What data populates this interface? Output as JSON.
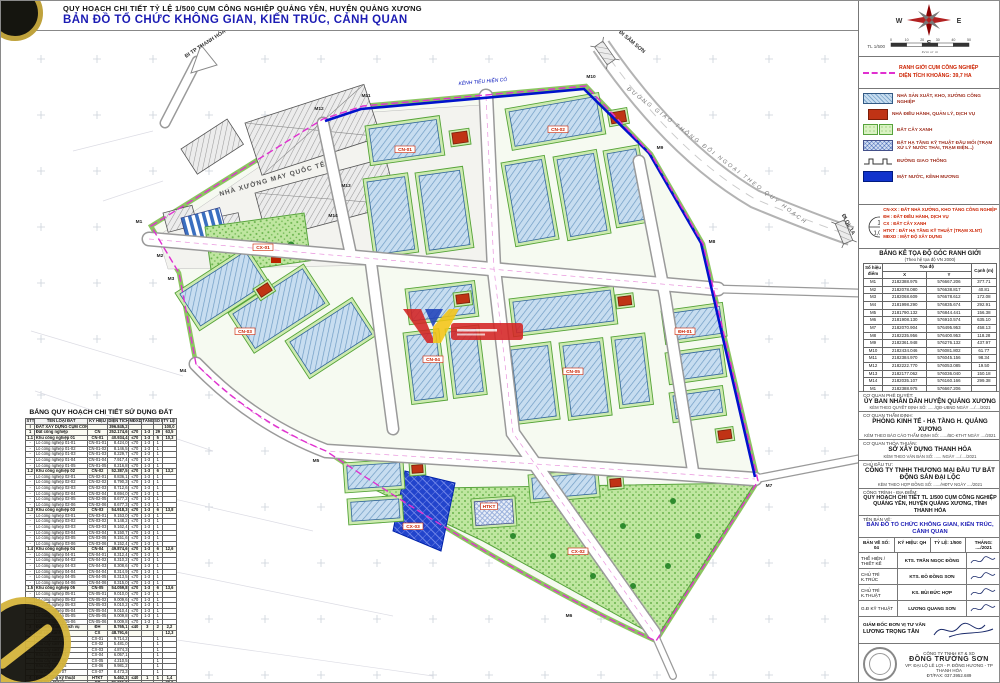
{
  "colors": {
    "accent_blue": "#1c1cb4",
    "boundary_magenta": "#e030d0",
    "red": "#cc2200",
    "canal_blue": "#0012cc",
    "lot_green": "#55a337",
    "building_blue": "#c7ddf0"
  },
  "header": {
    "line1": "QUY HOẠCH CHI TIẾT TỶ LỆ 1/500 CỤM CÔNG NGHIỆP QUẢNG YÊN, HUYỆN QUẢNG XƯƠNG",
    "line2": "BẢN ĐỒ TỔ CHỨC KHÔNG GIAN, KIẾN TRÚC, CẢNH QUAN"
  },
  "compass": {
    "w": "W",
    "e": "E",
    "s": "S",
    "scale_label": "TL 1/500",
    "scale_unit": "Đơn vị: m",
    "ticks": [
      "0",
      "10",
      "20",
      "30",
      "40",
      "50"
    ]
  },
  "boundary_legend": {
    "line1": "RANH GIỚI CỤM CÔNG NGHIỆP",
    "line2": "DIỆN TÍCH KHOẢNG: 39,7 HA"
  },
  "legend": {
    "items": [
      {
        "cls": "sw-cn",
        "text": "NHÀ SẢN XUẤT, KHO, XƯỞNG CÔNG NGHIỆP"
      },
      {
        "cls": "sw-dh",
        "text": "NHÀ ĐIỀU HÀNH, QUẢN LÝ, DỊCH VỤ"
      },
      {
        "cls": "sw-cx",
        "text": "ĐẤT CÂY XANH"
      },
      {
        "cls": "sw-htkt",
        "text": "ĐẤT HẠ TẦNG KỸ THUẬT ĐẦU MỐI (TRẠM XỬ LÝ NƯỚC THẢI, TRẠM ĐIỆN...)"
      },
      {
        "cls": "sw-road",
        "text": "ĐƯỜNG GIAO THÔNG"
      },
      {
        "cls": "sw-mn",
        "text": "MẶT NƯỚC, KÊNH MƯƠNG"
      }
    ]
  },
  "symbols": {
    "circle_top": "1",
    "circle_bottom": "1,05",
    "callout_top": "SỐ Ô ĐẤT",
    "callout_bottom": "DT (HA)",
    "lines": [
      "CN-XX : ĐẤT NHÀ XƯỞNG, KHO TÀNG CÔNG NGHIỆP",
      "ĐH : ĐẤT ĐIỀU HÀNH, DỊCH VỤ",
      "CX : ĐẤT CÂY XANH",
      "HTKT : ĐẤT HẠ TẦNG KỸ THUẬT (TRẠM XLNT)",
      "MĐXD : MẬT ĐỘ XÂY DỰNG"
    ]
  },
  "coord_table": {
    "title": "BẢNG KÊ TỌA ĐỘ GÓC RANH GIỚI",
    "subtitle": "(Theo hệ tọa độ VN 2000)",
    "c_point": "Số hiệu điểm",
    "c_coord": "Tọa độ",
    "c_x": "X",
    "c_y": "Y",
    "c_edge": "Cạnh (m)",
    "rows": [
      [
        "M1",
        "2182388.975",
        "576667.206",
        "377.71"
      ],
      [
        "M2",
        "2182078.080",
        "576638.817",
        "40.81"
      ],
      [
        "M3",
        "2182068.609",
        "576678.612",
        "172.08"
      ],
      [
        "M4",
        "2181998.290",
        "576835.674",
        "292.91"
      ],
      [
        "M5",
        "2181790.132",
        "576844.441",
        "156.38"
      ],
      [
        "M6",
        "2181908.130",
        "576910.574",
        "635.10"
      ],
      [
        "M7",
        "2182070.904",
        "576495.953",
        "458.13"
      ],
      [
        "M8",
        "2182235.956",
        "576400.953",
        "118.28"
      ],
      [
        "M9",
        "2182361.948",
        "576276.132",
        "437.97"
      ],
      [
        "M10",
        "2182434.046",
        "576081.802",
        "61.77"
      ],
      [
        "M11",
        "2182384.970",
        "576045.156",
        "98.34"
      ],
      [
        "M12",
        "2182222.770",
        "576053.085",
        "19.50"
      ],
      [
        "M13",
        "2182177.062",
        "576036.040",
        "150.18"
      ],
      [
        "M14",
        "2182035.107",
        "576160.166",
        "299.38"
      ],
      [
        "M1",
        "2182388.975",
        "576667.206",
        ""
      ]
    ]
  },
  "landuse": {
    "title": "BẢNG QUY HOẠCH CHI TIẾT SỬ DỤNG ĐẤT",
    "cols": [
      "STT",
      "TÊN LOẠI ĐẤT",
      "KÝ HIỆU",
      "DIỆN TÍCH (m²)",
      "MĐXD (%)",
      "TẦNG CAO",
      "SỐ LÔ",
      "TỶ LỆ (%)"
    ],
    "rows": [
      [
        "I",
        "ĐẤT XÂY DỰNG CỤM CÔNG NGHIỆP",
        "",
        "396.845,2",
        "",
        "",
        "",
        "100,0",
        "b"
      ],
      [
        "1",
        "Đất công nghiệp",
        "CN",
        "252.174,6",
        "≤70",
        "1-3",
        "29",
        "63,5",
        "b"
      ],
      [
        "1.1",
        "Khu công nghiệp 01",
        "CN-01",
        "40.934,4",
        "≤70",
        "1-3",
        "5",
        "10,3",
        "b"
      ],
      [
        "-",
        "Lô công nghiệp 01-01",
        "CN-01-01",
        "8.424,0",
        "≤70",
        "1-3",
        "1",
        "",
        ""
      ],
      [
        "-",
        "Lô công nghiệp 01-02",
        "CN-01-02",
        "8.146,5",
        "≤70",
        "1-3",
        "1",
        "",
        ""
      ],
      [
        "-",
        "Lô công nghiệp 01-03",
        "CN-01-03",
        "8.229,7",
        "≤70",
        "1-3",
        "1",
        "",
        ""
      ],
      [
        "-",
        "Lô công nghiệp 01-04",
        "CN-01-04",
        "7.917,4",
        "≤70",
        "1-3",
        "1",
        "",
        ""
      ],
      [
        "-",
        "Lô công nghiệp 01-05",
        "CN-01-05",
        "8.216,8",
        "≤70",
        "1-3",
        "1",
        "",
        ""
      ],
      [
        "1.2",
        "Khu công nghiệp 02",
        "CN-02",
        "52.387,5",
        "≤70",
        "1-3",
        "6",
        "13,2",
        "b"
      ],
      [
        "-",
        "Lô công nghiệp 02-01",
        "CN-02-01",
        "8.836,1",
        "≤70",
        "1-3",
        "1",
        "",
        ""
      ],
      [
        "-",
        "Lô công nghiệp 02-02",
        "CN-02-02",
        "8.790,3",
        "≤70",
        "1-3",
        "1",
        "",
        ""
      ],
      [
        "-",
        "Lô công nghiệp 02-03",
        "CN-02-03",
        "8.712,6",
        "≤70",
        "1-3",
        "1",
        "",
        ""
      ],
      [
        "-",
        "Lô công nghiệp 02-04",
        "CN-02-04",
        "8.694,0",
        "≤70",
        "1-3",
        "1",
        "",
        ""
      ],
      [
        "-",
        "Lô công nghiệp 02-05",
        "CN-02-05",
        "8.677,2",
        "≤70",
        "1-3",
        "1",
        "",
        ""
      ],
      [
        "-",
        "Lô công nghiệp 02-06",
        "CN-02-06",
        "8.677,3",
        "≤70",
        "1-3",
        "1",
        "",
        ""
      ],
      [
        "1.3",
        "Khu công nghiệp 03",
        "CN-03",
        "54.918,3",
        "≤70",
        "1-3",
        "6",
        "13,8",
        "b"
      ],
      [
        "-",
        "Lô công nghiệp 03-01",
        "CN-03-01",
        "9.153,0",
        "≤70",
        "1-3",
        "1",
        "",
        ""
      ],
      [
        "-",
        "Lô công nghiệp 03-02",
        "CN-03-02",
        "9.148,2",
        "≤70",
        "1-3",
        "1",
        "",
        ""
      ],
      [
        "-",
        "Lô công nghiệp 03-03",
        "CN-03-03",
        "9.162,4",
        "≤70",
        "1-3",
        "1",
        "",
        ""
      ],
      [
        "-",
        "Lô công nghiệp 03-04",
        "CN-03-04",
        "9.150,7",
        "≤70",
        "1-3",
        "1",
        "",
        ""
      ],
      [
        "-",
        "Lô công nghiệp 03-05",
        "CN-03-05",
        "9.151,6",
        "≤70",
        "1-3",
        "1",
        "",
        ""
      ],
      [
        "-",
        "Lô công nghiệp 03-06",
        "CN-03-06",
        "9.152,4",
        "≤70",
        "1-3",
        "1",
        "",
        ""
      ],
      [
        "1.4",
        "Khu công nghiệp 04",
        "CN-04",
        "49.874,6",
        "≤70",
        "1-3",
        "6",
        "12,6",
        "b"
      ],
      [
        "-",
        "Lô công nghiệp 04-01",
        "CN-04-01",
        "8.312,4",
        "≤70",
        "1-3",
        "1",
        "",
        ""
      ],
      [
        "-",
        "Lô công nghiệp 04-02",
        "CN-04-02",
        "8.310,2",
        "≤70",
        "1-3",
        "1",
        "",
        ""
      ],
      [
        "-",
        "Lô công nghiệp 04-03",
        "CN-04-03",
        "8.308,6",
        "≤70",
        "1-3",
        "1",
        "",
        ""
      ],
      [
        "-",
        "Lô công nghiệp 04-04",
        "CN-04-04",
        "8.314,9",
        "≤70",
        "1-3",
        "1",
        "",
        ""
      ],
      [
        "-",
        "Lô công nghiệp 04-05",
        "CN-04-05",
        "8.313,5",
        "≤70",
        "1-3",
        "1",
        "",
        ""
      ],
      [
        "-",
        "Lô công nghiệp 04-06",
        "CN-04-06",
        "8.315,0",
        "≤70",
        "1-3",
        "1",
        "",
        ""
      ],
      [
        "1.5",
        "Khu công nghiệp 05",
        "CN-05",
        "54.059,8",
        "≤70",
        "1-3",
        "6",
        "13,6",
        "b"
      ],
      [
        "-",
        "Lô công nghiệp 05-01",
        "CN-05-01",
        "9.010,0",
        "≤70",
        "1-3",
        "1",
        "",
        ""
      ],
      [
        "-",
        "Lô công nghiệp 05-02",
        "CN-05-02",
        "9.009,6",
        "≤70",
        "1-3",
        "1",
        "",
        ""
      ],
      [
        "-",
        "Lô công nghiệp 05-03",
        "CN-05-03",
        "9.010,2",
        "≤70",
        "1-3",
        "1",
        "",
        ""
      ],
      [
        "-",
        "Lô công nghiệp 05-04",
        "CN-05-04",
        "9.010,4",
        "≤70",
        "1-3",
        "1",
        "",
        ""
      ],
      [
        "-",
        "Lô công nghiệp 05-05",
        "CN-05-05",
        "9.009,8",
        "≤70",
        "1-3",
        "1",
        "",
        ""
      ],
      [
        "-",
        "Lô công nghiệp 05-06",
        "CN-05-06",
        "9.009,8",
        "≤70",
        "1-3",
        "1",
        "",
        ""
      ],
      [
        "2",
        "Đất điều hành, dịch vụ",
        "ĐH",
        "8.765,1",
        "≤40",
        "3",
        "2",
        "2,2",
        "b"
      ],
      [
        "3",
        "Đất cây xanh",
        "CX",
        "48.791,6",
        "",
        "",
        "",
        "12,3",
        "b"
      ],
      [
        "-",
        "Khu cây xanh 01",
        "CX-01",
        "9.714,2",
        "",
        "",
        "1",
        "",
        ""
      ],
      [
        "-",
        "Khu cây xanh 02",
        "CX-02",
        "5.481,0",
        "",
        "",
        "1",
        "",
        ""
      ],
      [
        "-",
        "Khu cây xanh 03",
        "CX-03",
        "4.874,3",
        "",
        "",
        "1",
        "",
        ""
      ],
      [
        "-",
        "Khu cây xanh 04",
        "CX-04",
        "6.057,1",
        "",
        "",
        "1",
        "",
        ""
      ],
      [
        "-",
        "Khu cây xanh 05",
        "CX-05",
        "4.210,5",
        "",
        "",
        "1",
        "",
        ""
      ],
      [
        "-",
        "Khu cây xanh 06",
        "CX-06",
        "9.981,2",
        "",
        "",
        "1",
        "",
        ""
      ],
      [
        "-",
        "Khu cây xanh 07",
        "CX-07",
        "8.473,3",
        "",
        "",
        "1",
        "",
        ""
      ],
      [
        "4",
        "Đất hạ tầng kỹ thuật",
        "HTKT",
        "5.462,3",
        "≤40",
        "1",
        "1",
        "1,4",
        "b"
      ],
      [
        "5",
        "Đất giao thông",
        "GT",
        "81.651,6",
        "",
        "",
        "",
        "20,6",
        "b"
      ],
      [
        "",
        "TỔNG CỘNG",
        "",
        "396.845,2",
        "",
        "",
        "",
        "100,0",
        "b"
      ]
    ]
  },
  "titleblock": {
    "approvals": [
      {
        "label": "CƠ QUAN PHÊ DUYỆT:",
        "name": "ỦY BAN NHÂN DÂN HUYỆN QUẢNG XƯƠNG",
        "note": "KÈM THEO QUYẾT ĐỊNH SỐ: ....../QĐ-UBND  NGÀY ..../..../2021"
      },
      {
        "label": "CƠ QUAN THẨM ĐỊNH:",
        "name": "PHÒNG KINH TẾ - HẠ TẦNG H. QUẢNG XƯƠNG",
        "note": "KÈM THEO BÁO CÁO THẨM ĐỊNH SỐ: ....../BC-KTHT  NGÀY ..../2021"
      },
      {
        "label": "CƠ QUAN THỎA THUẬN:",
        "name": "SỞ XÂY DỰNG THANH HÓA",
        "note": "KÈM THEO VĂN BẢN SỐ: ......  NGÀY ..../..../2021"
      },
      {
        "label": "CHỦ ĐẦU TƯ:",
        "name": "CÔNG TY TNHH THƯƠNG MẠI ĐẦU TƯ BẤT ĐỘNG SẢN ĐẠI LỘC",
        "note": "KÈM THEO HỢP ĐỒNG SỐ: ....../HĐTV  NGÀY ..../2021"
      }
    ],
    "project_label": "CÔNG TRÌNH - ĐỊA ĐIỂM:",
    "project_name": "QUY HOẠCH CHI TIẾT TL 1/500 CỤM CÔNG NGHIỆP QUẢNG YÊN, HUYỆN QUẢNG XƯƠNG, TỈNH THANH HÓA",
    "drawing_label": "TÊN BẢN VẼ:",
    "drawing_name": "BẢN ĐỒ TỔ CHỨC KHÔNG GIAN, KIẾN TRÚC, CẢNH QUAN",
    "meta": [
      "BẢN VẼ SỐ: 04",
      "KÝ HIỆU: QH",
      "TỶ LỆ: 1/500",
      "THÁNG: ..../2021"
    ],
    "signatures": [
      {
        "role": "THỂ HIỆN / THIẾT KẾ",
        "name": "KTS. TRẦN NGỌC ĐỒNG"
      },
      {
        "role": "CHỦ TRÌ K.TRÚC",
        "name": "KTS. ĐỖ ĐỒNG SƠN"
      },
      {
        "role": "CHỦ TRÌ K.THUẬT",
        "name": "KS. BÙI ĐỨC HỢP"
      },
      {
        "role": "G.Đ KỸ THUẬT",
        "name": "LƯƠNG QUANG SƠN"
      }
    ],
    "consultant_label": "GIÁM ĐỐC ĐƠN VỊ TƯ VẤN",
    "consultant_name": "LƯƠNG TRỌNG TÂN",
    "company_small": "CÔNG TY TNHH KT & XD",
    "company_big": "ĐỒNG TRƯỜNG SƠN",
    "company_addr": "VP: ĐẠI LỘ LÊ LỢI - P. ĐÔNG HƯƠNG - TP THANH HÓA",
    "company_tel": "ĐT/FAX: 037.3952.689"
  },
  "map": {
    "labels": [
      {
        "t": "ĐI TP THANH HÓA",
        "x": 193,
        "y": 14,
        "r": -33,
        "c": "rd"
      },
      {
        "t": "ĐI SẦM SƠN",
        "x": 618,
        "y": 12,
        "r": 40,
        "c": "rd"
      },
      {
        "t": "ĐI QL.1A",
        "x": 834,
        "y": 194,
        "r": 62,
        "c": "rd"
      },
      {
        "t": "ĐƯỜNG GIAO THÔNG ĐỐI NGOẠI THEO QUY HOẠCH",
        "x": 703,
        "y": 126,
        "r": 37,
        "c": "rdit"
      },
      {
        "t": "NHÀ XƯỞNG MAY QUỐC TẾ",
        "x": 260,
        "y": 150,
        "r": -16,
        "c": "fac"
      },
      {
        "t": "KÊNH TIÊU HIỆN CÓ",
        "x": 470,
        "y": 52,
        "r": -5,
        "c": "bl"
      },
      {
        "t": "M1",
        "x": 126,
        "y": 192,
        "c": "m"
      },
      {
        "t": "M2",
        "x": 147,
        "y": 226,
        "c": "m"
      },
      {
        "t": "M3",
        "x": 158,
        "y": 249,
        "c": "m"
      },
      {
        "t": "M4",
        "x": 170,
        "y": 341,
        "c": "m"
      },
      {
        "t": "M5",
        "x": 303,
        "y": 431,
        "c": "m"
      },
      {
        "t": "M6",
        "x": 556,
        "y": 586,
        "c": "m"
      },
      {
        "t": "M7",
        "x": 756,
        "y": 456,
        "c": "m"
      },
      {
        "t": "M8",
        "x": 699,
        "y": 212,
        "c": "m"
      },
      {
        "t": "M9",
        "x": 647,
        "y": 118,
        "c": "m"
      },
      {
        "t": "M10",
        "x": 578,
        "y": 47,
        "c": "m"
      },
      {
        "t": "M11",
        "x": 353,
        "y": 66,
        "c": "m"
      },
      {
        "t": "M12",
        "x": 306,
        "y": 79,
        "c": "m"
      },
      {
        "t": "M13",
        "x": 333,
        "y": 156,
        "c": "m"
      },
      {
        "t": "M14",
        "x": 320,
        "y": 186,
        "c": "m"
      },
      {
        "t": "CN-01",
        "x": 392,
        "y": 120,
        "c": "tag"
      },
      {
        "t": "CN-02",
        "x": 545,
        "y": 100,
        "c": "tag"
      },
      {
        "t": "CN-03",
        "x": 232,
        "y": 302,
        "c": "tag"
      },
      {
        "t": "CN-04",
        "x": 420,
        "y": 330,
        "c": "tag"
      },
      {
        "t": "CN-05",
        "x": 560,
        "y": 342,
        "c": "tag"
      },
      {
        "t": "ĐH-01",
        "x": 672,
        "y": 302,
        "c": "tag"
      },
      {
        "t": "CX-01",
        "x": 250,
        "y": 218,
        "c": "tag"
      },
      {
        "t": "CX-02",
        "x": 565,
        "y": 522,
        "c": "tag"
      },
      {
        "t": "CX-03",
        "x": 400,
        "y": 497,
        "c": "tag"
      },
      {
        "t": "HTKT",
        "x": 476,
        "y": 477,
        "c": "tag"
      }
    ]
  }
}
